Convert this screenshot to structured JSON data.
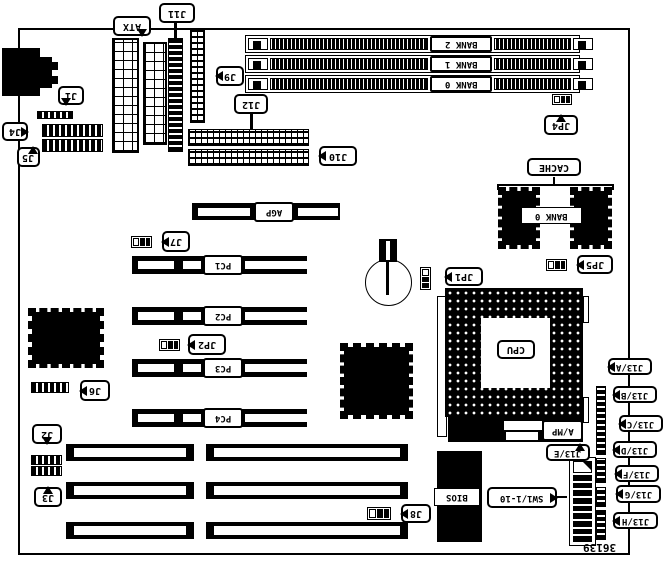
{
  "diagram": {
    "part_number": "36139",
    "labels": {
      "atx": "ATX",
      "j11": "J11",
      "j9": "J9",
      "j12": "J12",
      "j10": "J10",
      "j1": "J1",
      "j4": "J4",
      "j5": "J5",
      "bank2": "BANK 2",
      "bank1": "BANK 1",
      "bank0_dimm": "BANK 0",
      "jp4": "JP4",
      "cache": "CACHE",
      "bank0_cache": "BANK 0",
      "jp5": "JP5",
      "agp": "AGP",
      "j7": "J7",
      "pc1": "PC1",
      "pc2": "PC2",
      "jp2": "JP2",
      "pc3": "PC3",
      "j6": "J6",
      "pc4": "PC4",
      "j2": "J2",
      "j3": "J3",
      "j8": "J8",
      "bios": "BIOS",
      "jp1": "JP1",
      "cpu": "CPU",
      "amp": "A/MP",
      "j13a": "J13/A",
      "j13b": "J13/B",
      "j13c": "J13/C",
      "j13d": "J13/D",
      "j13e": "J13/E",
      "j13f": "J13/F",
      "j13g": "J13/G",
      "j13h": "J13/H",
      "sw1": "SW1/1-10"
    }
  }
}
